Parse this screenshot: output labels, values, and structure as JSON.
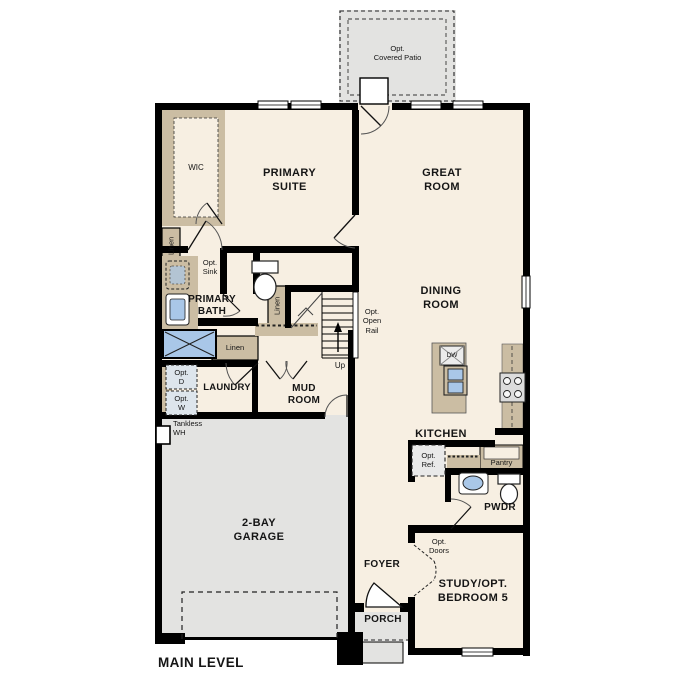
{
  "title": "MAIN LEVEL",
  "colors": {
    "wall": "#000000",
    "floor": "#f7efe2",
    "closet_tan": "#cbbda3",
    "exterior_gray": "#e3e3e1",
    "fixture_blue": "#a9c7e8",
    "appliance_gray": "#dcdcdc"
  },
  "rooms": {
    "covered_patio": "Opt.\nCovered Patio",
    "wic": "WIC",
    "primary_suite": "PRIMARY\nSUITE",
    "great_room": "GREAT\nROOM",
    "primary_bath": "PRIMARY\nBATH",
    "dining_room": "DINING\nROOM",
    "kitchen": "KITCHEN",
    "laundry": "LAUNDRY",
    "mud_room": "MUD\nROOM",
    "garage": "2-BAY\nGARAGE",
    "pwdr": "PWDR",
    "foyer": "FOYER",
    "study": "STUDY/OPT.\nBEDROOM 5",
    "porch": "PORCH"
  },
  "features": {
    "linen_primary": "Linen",
    "linen_bath": "Linen",
    "linen_hall": "Linen",
    "opt_sink": "Opt.\nSink",
    "opt_open_rail": "Opt.\nOpen\nRail",
    "up": "Up",
    "dishwasher": "DW",
    "opt_ref": "Opt.\nRef.",
    "pantry": "Pantry",
    "opt_dryer": "Opt.\nD",
    "opt_washer": "Opt.\nW",
    "tankless_wh": "Tankless\nWH",
    "opt_doors": "Opt.\nDoors"
  }
}
